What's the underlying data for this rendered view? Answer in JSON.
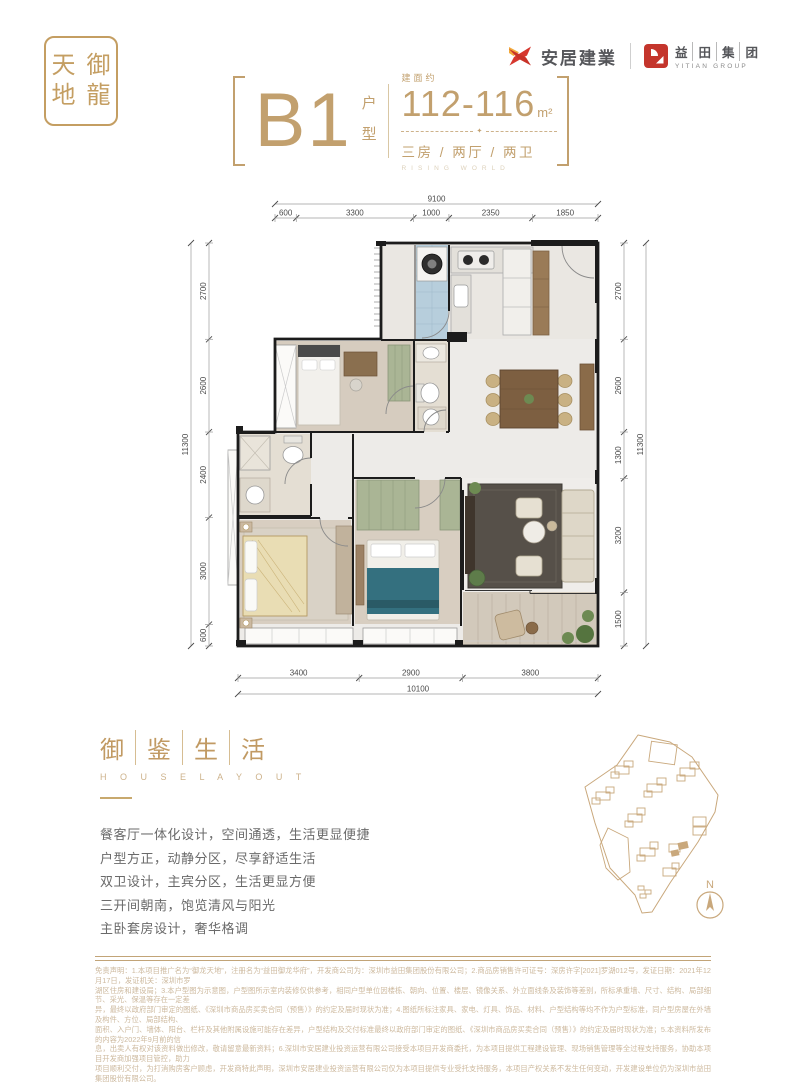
{
  "colors": {
    "accent_gold": "#C2A06E",
    "brand_red": "#D0372E",
    "brand_yellow": "#F2A93B",
    "disclaimer_tan": "#CDB99E"
  },
  "brand": {
    "seal_chars": [
      "天",
      "御",
      "地",
      "龍"
    ],
    "anju": {
      "label": "安居建業"
    },
    "yitian": {
      "chars": [
        "益",
        "田",
        "集",
        "团"
      ],
      "sub": "YITIAN GROUP"
    }
  },
  "title": {
    "unit": "B1",
    "unit_suffix": "户型",
    "area_label": "建面约",
    "area_value": "112-116",
    "area_unit": "m²",
    "divider_star": "✦",
    "layout": "三房 / 两厅 / 两卫",
    "layout_sub": "RISING WORLD"
  },
  "floorplan": {
    "dims": {
      "top": {
        "overall": "9100",
        "segments": [
          "600",
          "3300",
          "1000",
          "2350",
          "1850"
        ]
      },
      "bottom": {
        "overall": "10100",
        "segments": [
          "3400",
          "2900",
          "3800"
        ]
      },
      "left": {
        "overall": "11300",
        "segments": [
          "2700",
          "2600",
          "2400",
          "3000",
          "600"
        ]
      },
      "right": {
        "overall": "11300",
        "segments": [
          "2700",
          "2600",
          "1300",
          "3200",
          "1500"
        ]
      }
    }
  },
  "features": {
    "heading_chars": [
      "御",
      "鉴",
      "生",
      "活"
    ],
    "heading_sub": "H O U S E   L A Y O U T",
    "items": [
      "餐客厅一体化设计，空间通透，生活更显便捷",
      "户型方正，动静分区，尽享舒适生活",
      "双卫设计，主宾分区，生活更显方便",
      "三开间朝南，饱览清风与阳光",
      "主卧套房设计，奢华格调"
    ]
  },
  "siteplan": {
    "compass_label": "N"
  },
  "disclaimer": {
    "lines": [
      "免责声明：1.本项目推广名为“御龙天地”，注册名为“益田御龙华府”，开发商公司为：深圳市益田集团股份有限公司；2.商品房销售许可证号：深房许字[2021]罗湖012号，发证日期：2021年12月17日，发证机关：深圳市罗",
      "湖区住房和建设局；3.本户型图为示意图，户型图所示室内装修仅供参考，相同户型单位因楼栋、朝向、位置、楼层、镜像关系、外立面线条及装饰等差别，所标承重墙、尺寸、结构、局部细节、采光、保温等存在一定差",
      "异，最终以政府部门审定的图纸、《深圳市商品房买卖合同（预售）》的约定及届时现状为准；4.图纸所标注家具、家电、灯具、饰品、材料、户型结构等均不作为户型标准，同户型房屋在外墙及构件、方位、局部结构、",
      "面积、入户门、墙体、阳台、栏杆及其他附属设施可能存在差异，户型结构及交付标准最终以政府部门审定的图纸、《深圳市商品房买卖合同（预售）》的约定及届时现状为准；5.本资料所发布的内容为2022年9月前的信",
      "息，出卖人有权对该资料做出修改，敬请留意最新资料；6.深圳市安居建业投资运营有限公司接受本项目开发商委托，为本项目提供工程建设管理、现场销售管理等全过程支持服务，协助本项目开发商加强项目管控，助力",
      "项目顺利交付，为打消购房客户顾虑，开发商特此声明，深圳市安居建业投资运营有限公司仅为本项目提供专业受托支持服务，本项目产权关系不发生任何变动，开发建设单位仍为深圳市益田集团股份有限公司。"
    ]
  }
}
